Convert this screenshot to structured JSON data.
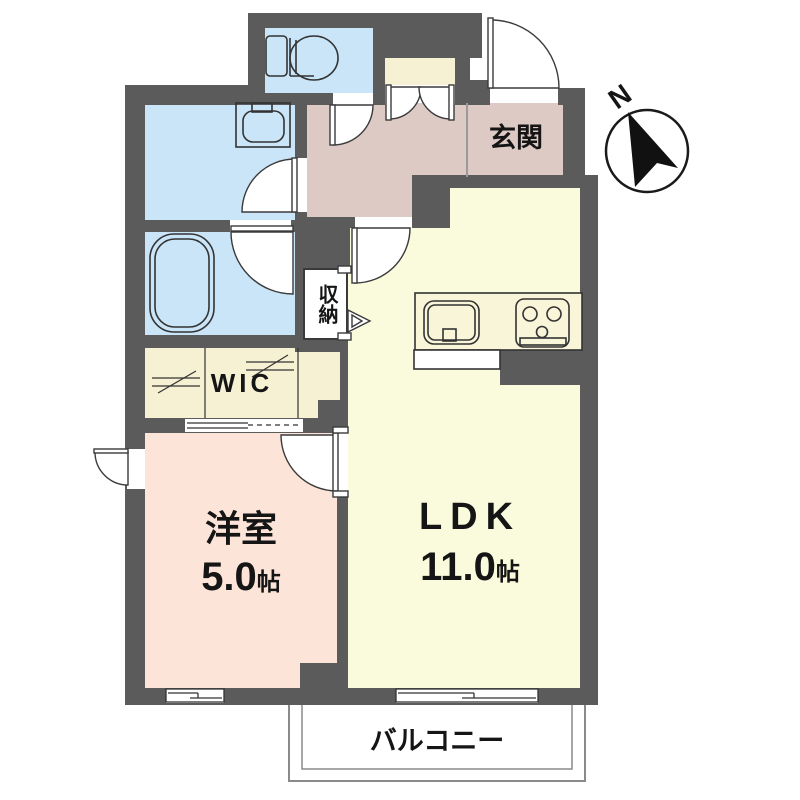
{
  "plan": {
    "title": "apartment-floor-plan",
    "compass": {
      "north_label": "N"
    },
    "rooms": {
      "entrance": {
        "label": "玄関"
      },
      "storage": {
        "label": "収納"
      },
      "wic": {
        "label": "WIC"
      },
      "western_room": {
        "label": "洋室",
        "size_value": "5.0",
        "size_unit": "帖"
      },
      "ldk": {
        "label": "LDK",
        "size_value": "11.0",
        "size_unit": "帖"
      },
      "balcony": {
        "label": "バルコニー"
      }
    },
    "fixtures": [
      "toilet",
      "washbasin",
      "bathtub",
      "kitchen-sink",
      "gas-stove"
    ],
    "colors": {
      "wall": "#5b5b5b",
      "wet_area": "#c9e5f7",
      "hall": "#decac5",
      "ldk": "#fafadc",
      "western_room": "#fce4d8",
      "closet": "#f6f1d3",
      "outline": "#3a3a3a"
    }
  }
}
